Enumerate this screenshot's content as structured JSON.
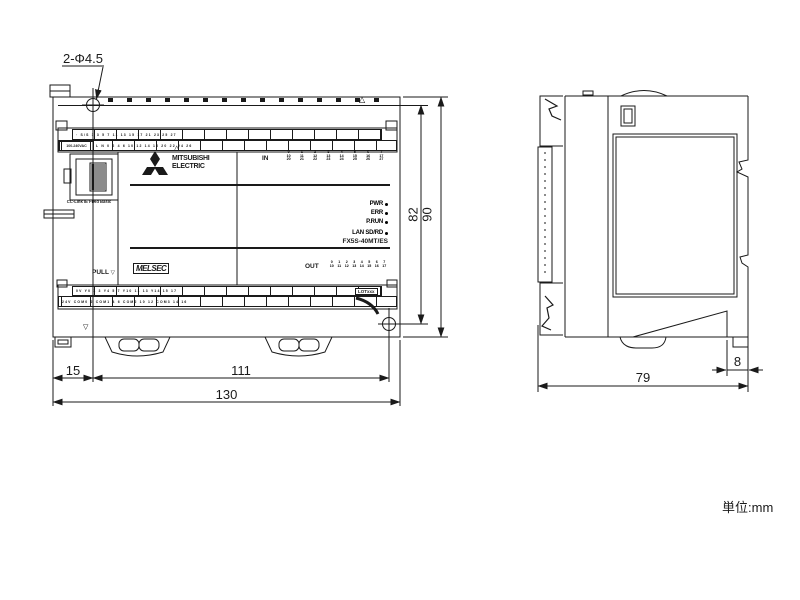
{
  "unit_label": "単位:mm",
  "marks": {
    "up": "△",
    "down": "▽"
  },
  "dimensions": {
    "hole_note": "2-Φ4.5",
    "left_offset": "15",
    "hole_span": "111",
    "width": "130",
    "hole_height": "82",
    "height": "90",
    "depth": "79",
    "rail_offset": "8"
  },
  "front": {
    "power_rating": "100-240VAC",
    "port_label": "CC-Link IE Field Basic",
    "brand_line1": "MITSUBISHI",
    "brand_line2": "ELECTRIC",
    "melsec": "MELSEC",
    "pull": "PULL",
    "in_label": "IN",
    "out_label": "OUT",
    "model": "FX5S-40MT/ES",
    "lot": "LOTxxx",
    "status_leds": [
      "PWR",
      "ERR",
      "P.RUN",
      "LAN SD/RD"
    ],
    "in_cols": [
      "0\n10\n20",
      "1\n11\n21",
      "2\n12\n22",
      "3\n13\n23",
      "4\n14\n24",
      "5\n15\n25",
      "6\n16\n26",
      "7\n17\n27"
    ],
    "out_cols": [
      "0\n10",
      "1\n11",
      "2\n12",
      "3\n13",
      "4\n14",
      "5\n15",
      "6\n16",
      "7\n17"
    ],
    "terminal_top_row1": "· S/S 1 3 5 7 11 13 15 17 21 23 25 27",
    "terminal_top_row2": "L N 0 2 4 6 10 12 14 16 20 22 24 26",
    "terminal_bottom_row1": "0V Y0 1 3 Y4 5 7 Y10 11 13 Y14 15 17",
    "terminal_bottom_row2": "24V COM0 2 COM1 4 6 COM2 10 12 COM3 14 16"
  }
}
